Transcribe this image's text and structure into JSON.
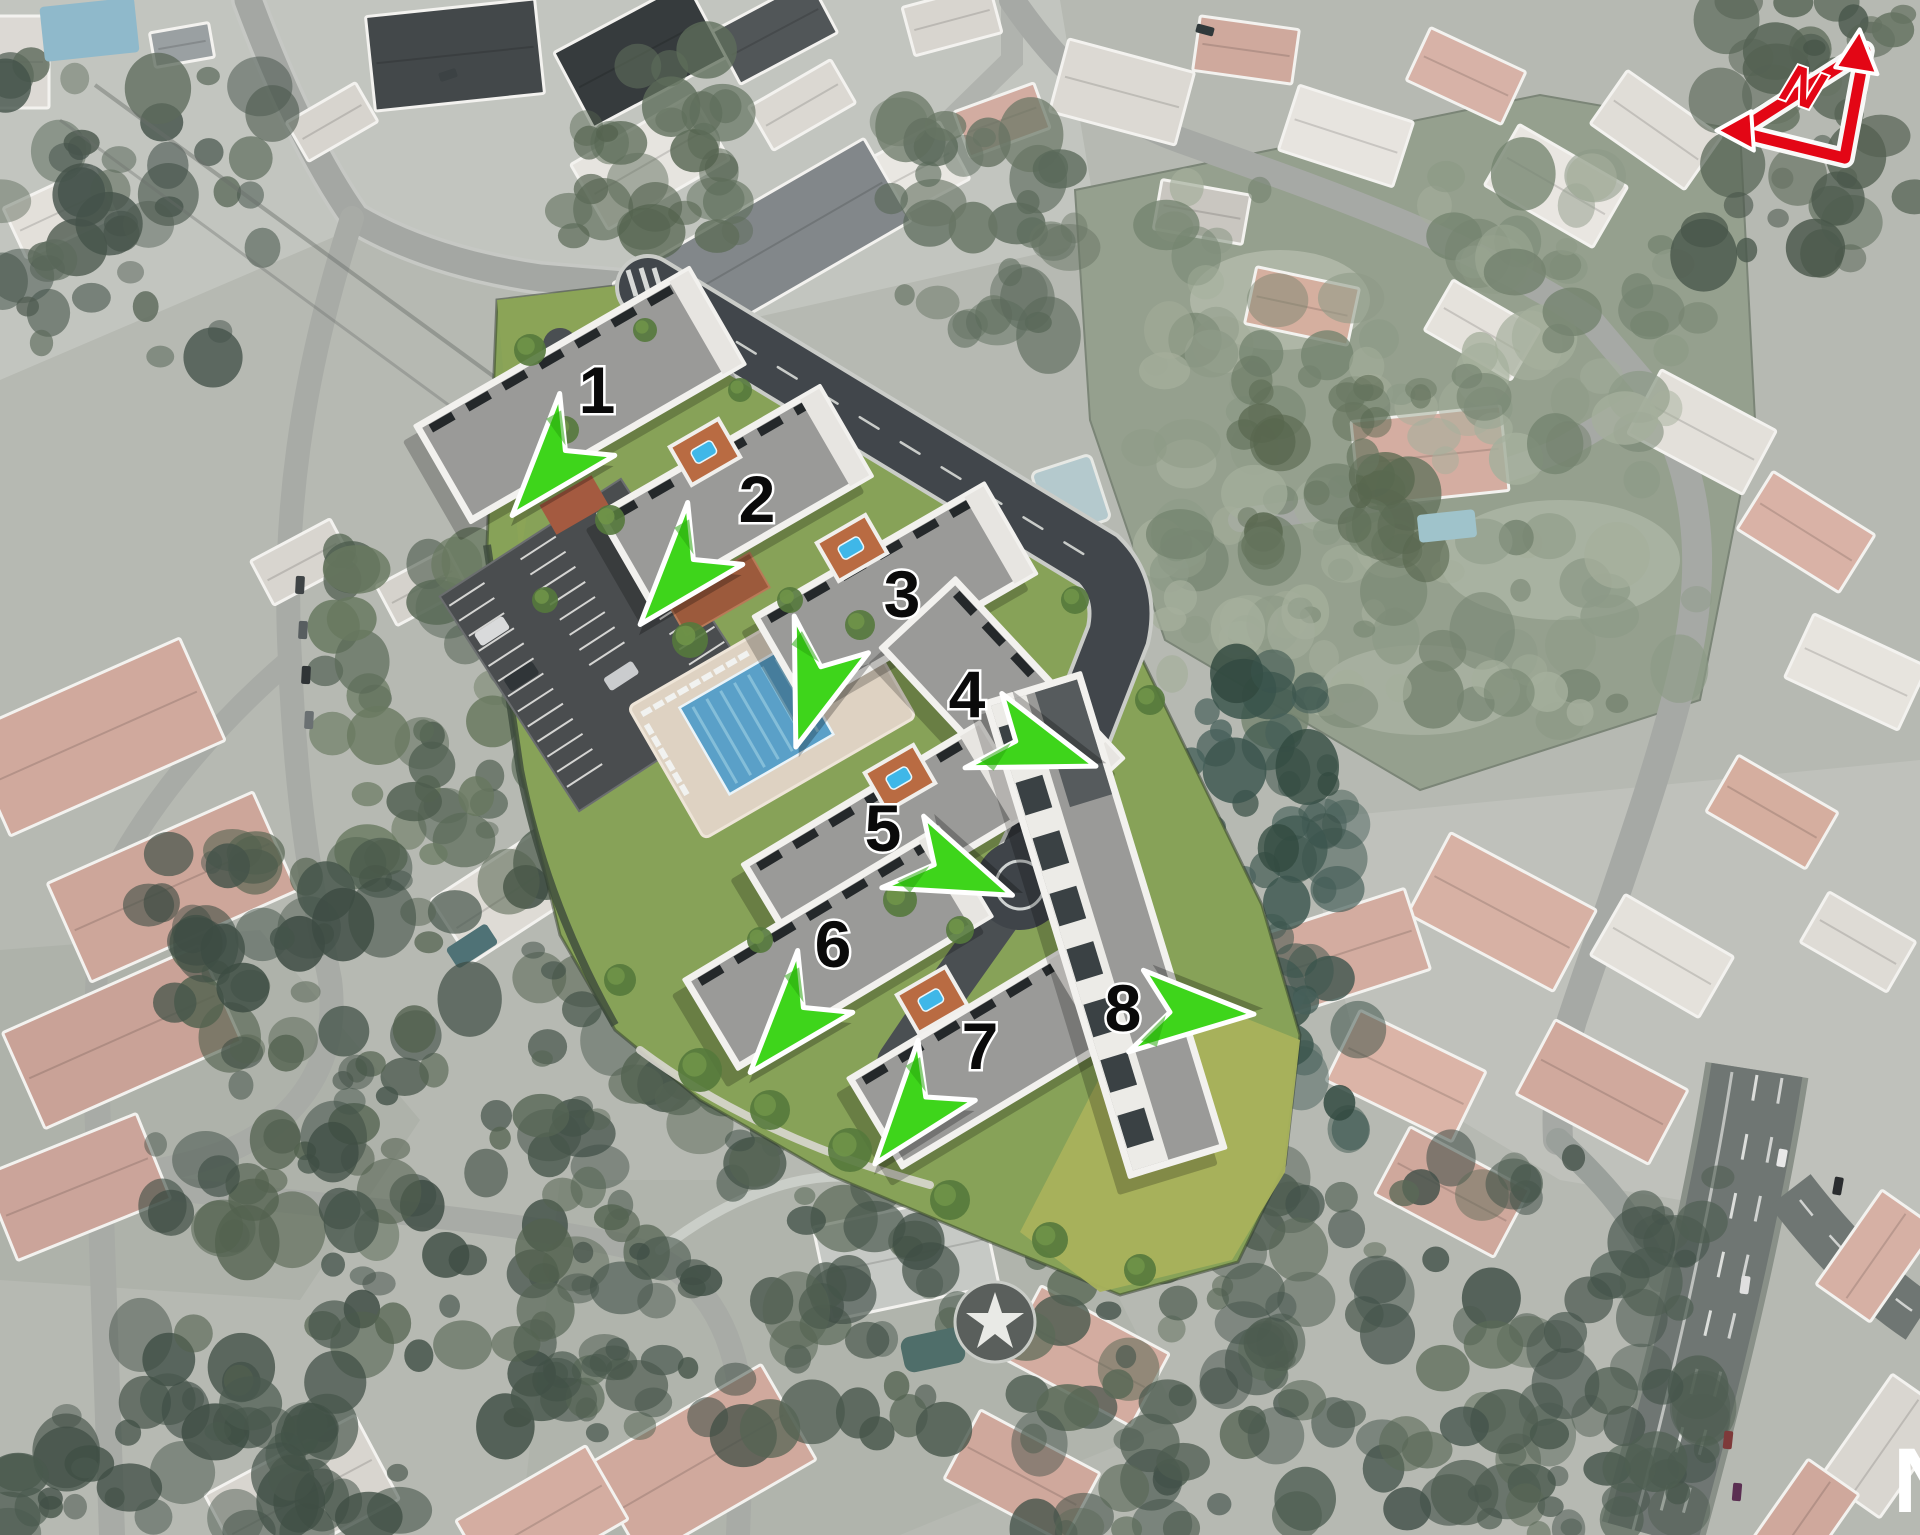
{
  "scene": {
    "description": "Aerial satellite masterplan of a residential development, eight numbered apartment buildings with communal pool, parking and landscaped grounds, surrounded by a desaturated villa neighbourhood",
    "width": 1920,
    "height": 1535
  },
  "site_plan": {
    "buildings": [
      {
        "label": "1",
        "x": 597,
        "y": 390
      },
      {
        "label": "2",
        "x": 757,
        "y": 499
      },
      {
        "label": "3",
        "x": 902,
        "y": 594
      },
      {
        "label": "4",
        "x": 967,
        "y": 694
      },
      {
        "label": "5",
        "x": 883,
        "y": 828
      },
      {
        "label": "6",
        "x": 833,
        "y": 944
      },
      {
        "label": "7",
        "x": 980,
        "y": 1046
      },
      {
        "label": "8",
        "x": 1123,
        "y": 1008
      }
    ],
    "entrance_arrows": [
      {
        "x": 552,
        "y": 468,
        "rotation": 40
      },
      {
        "x": 680,
        "y": 577,
        "rotation": 40
      },
      {
        "x": 815,
        "y": 688,
        "rotation": 18
      },
      {
        "x": 1037,
        "y": 747,
        "rotation": -72
      },
      {
        "x": 955,
        "y": 872,
        "rotation": -68
      },
      {
        "x": 790,
        "y": 1025,
        "rotation": 40
      },
      {
        "x": 913,
        "y": 1115,
        "rotation": 38
      },
      {
        "x": 1192,
        "y": 1012,
        "rotation": -88
      }
    ],
    "colors": {
      "arrow_green": "#3ed51b",
      "north_red": "#e30615",
      "site_lawn": "#87a258",
      "pool_blue": "#5aa0c8",
      "building_roof": "#9a9a98",
      "label_ink": "#0a0a0a",
      "label_halo": "#ffffff"
    }
  },
  "north_arrow": {
    "letter": "N",
    "color": "#e30615",
    "x": 1806,
    "y": 95,
    "rotation": 20
  },
  "corner_watermark": {
    "letter": "N",
    "x": 1893,
    "y": 1512
  }
}
